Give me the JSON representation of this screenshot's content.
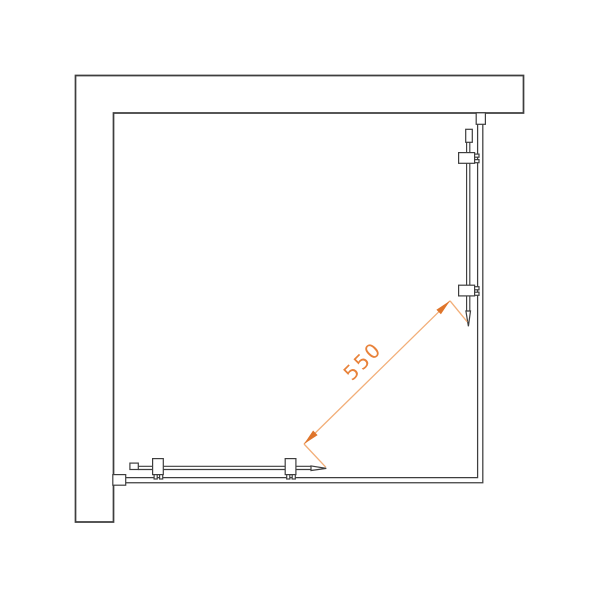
{
  "drawing": {
    "kind": "shower-enclosure-plan-view",
    "dimension": {
      "label": "550",
      "angle_deg": -45
    },
    "colors": {
      "background": "#ffffff",
      "line": "#3e3e3e",
      "dimension_line": "#f2ae78",
      "dimension_arrow": "#df752b",
      "dimension_text": "#e8823a"
    }
  }
}
